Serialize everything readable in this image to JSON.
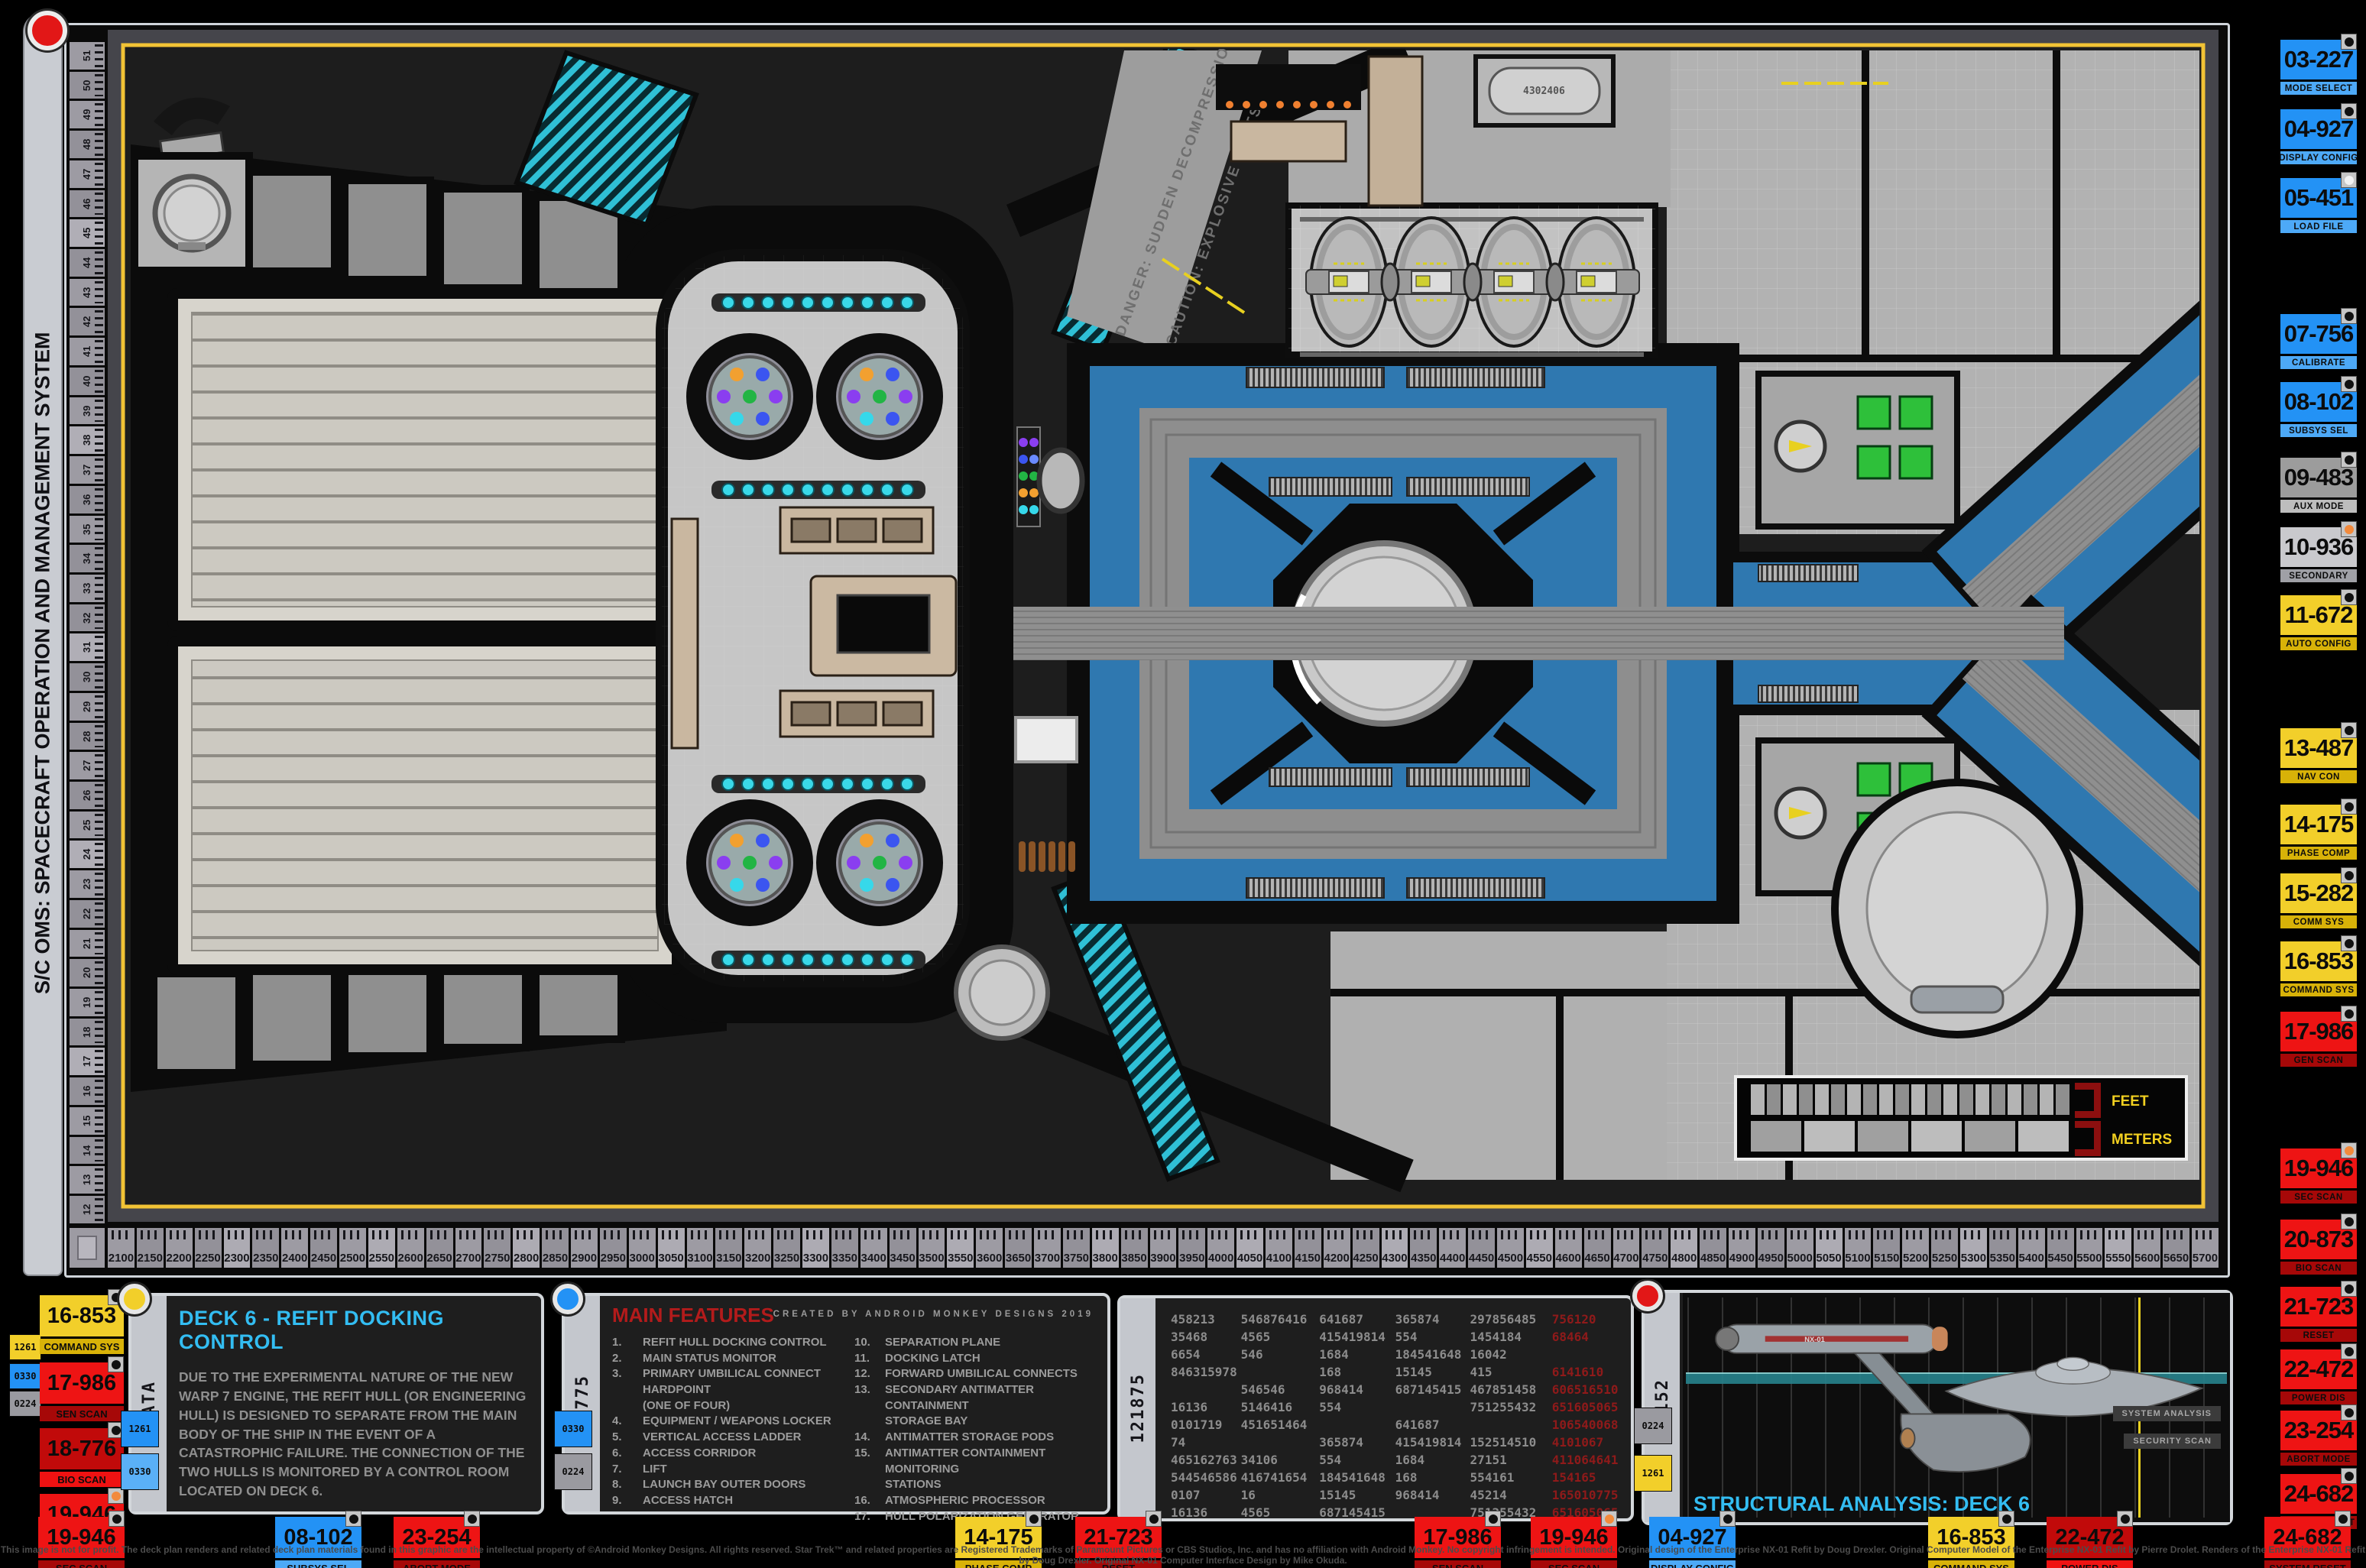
{
  "palette": {
    "blue": "#2392f5",
    "blue_label": "#4da9f7",
    "yellow": "#f2cf2a",
    "yellow_label": "#d8b208",
    "red": "#ee1414",
    "red_label": "#a60808",
    "dark_red": "#c10a0a",
    "dark_red_label": "#ef1212",
    "gray": "#9c9c9c",
    "gray_label": "#bdbdbd",
    "lightgray": "#c9c9cd",
    "lightgray_label": "#9fa0a6",
    "chip_yellow": "#f2cf2a",
    "chip_blue": "#2392f5",
    "chip_lightblue": "#5ab0f7",
    "chip_gray": "#9a9aa0",
    "dot_black": "#111111",
    "dot_orange": "#f28a3c",
    "dot_white": "#f2f2f2",
    "accent_cyan": "#33bdf2",
    "feature_red": "#b31b1b",
    "plan_blue": "#2f78b0",
    "teal": "#36c3d9",
    "ruler_yellow": "#f2c335"
  },
  "left_bar": {
    "title": "S/C OMS: SPACECRAFT OPERATION AND MANAGEMENT SYSTEM"
  },
  "rulers": {
    "horizontal": {
      "first": 2100,
      "last": 5700,
      "step": 50
    },
    "vertical": {
      "first": 51,
      "last": 12,
      "step": -1
    }
  },
  "plan": {
    "danger1": "DANGER: SUDDEN DECOMPRESSION AREA",
    "danger2": "CAUTION: EXPLOSIVE BOLTS",
    "feet": "FEET",
    "meters": "METERS",
    "cylinder_label": "4302406"
  },
  "right_sidebar": {
    "buttons": [
      {
        "code": "03-227",
        "label": "MODE SELECT",
        "color": "blue",
        "dot": "black"
      },
      {
        "code": "04-927",
        "label": "DISPLAY CONFIG",
        "color": "blue",
        "dot": "black"
      },
      {
        "code": "05-451",
        "label": "LOAD FILE",
        "color": "blue",
        "dot": "white"
      },
      {
        "code": "07-756",
        "label": "CALIBRATE",
        "color": "blue",
        "dot": "black"
      },
      {
        "code": "08-102",
        "label": "SUBSYS SEL",
        "color": "blue",
        "dot": "black"
      },
      {
        "code": "09-483",
        "label": "AUX MODE",
        "color": "gray",
        "dot": "black"
      },
      {
        "code": "10-936",
        "label": "SECONDARY",
        "color": "lightgray",
        "dot": "orange"
      },
      {
        "code": "11-672",
        "label": "AUTO CONFIG",
        "color": "yellow",
        "dot": "black"
      },
      {
        "code": "13-487",
        "label": "NAV CON",
        "color": "yellow",
        "dot": "black"
      },
      {
        "code": "14-175",
        "label": "PHASE COMP",
        "color": "yellow",
        "dot": "black"
      },
      {
        "code": "15-282",
        "label": "COMM SYS",
        "color": "yellow",
        "dot": "black"
      },
      {
        "code": "16-853",
        "label": "COMMAND SYS",
        "color": "yellow",
        "dot": "black"
      },
      {
        "code": "17-986",
        "label": "GEN SCAN",
        "color": "red",
        "dot": "black"
      },
      {
        "code": "19-946",
        "label": "SEC SCAN",
        "color": "red",
        "dot": "orange"
      },
      {
        "code": "20-873",
        "label": "BIO SCAN",
        "color": "red",
        "dot": "black"
      },
      {
        "code": "21-723",
        "label": "RESET",
        "color": "red",
        "dot": "black"
      },
      {
        "code": "22-472",
        "label": "POWER DIS",
        "color": "red",
        "dot": "black"
      },
      {
        "code": "23-254",
        "label": "ABORT MODE",
        "color": "red",
        "dot": "black"
      },
      {
        "code": "24-682",
        "label": "SYSTEM RESET",
        "color": "red",
        "dot": "black"
      }
    ]
  },
  "bottom": {
    "left_chips": [
      {
        "text": "1261",
        "color": "chip_yellow"
      },
      {
        "text": "0330",
        "color": "chip_blue"
      },
      {
        "text": "0224",
        "color": "chip_gray"
      }
    ],
    "left_buttons": [
      {
        "code": "16-853",
        "label": "COMMAND SYS",
        "color": "yellow",
        "dot": "black"
      },
      {
        "code": "17-986",
        "label": "SEN SCAN",
        "color": "red",
        "dot": "black"
      },
      {
        "code": "18-776",
        "label": "BIO SCAN",
        "color": "dark_red",
        "dot": "black"
      },
      {
        "code": "19-946",
        "label": "SEC SCAN",
        "color": "red",
        "dot": "orange"
      }
    ],
    "data_panel": {
      "tab": "DATA",
      "chips": [
        {
          "text": "1261",
          "color": "chip_blue"
        },
        {
          "text": "0330",
          "color": "chip_lightblue"
        }
      ],
      "title": "DECK 6 - REFIT DOCKING CONTROL",
      "body": "DUE TO THE EXPERIMENTAL NATURE OF THE NEW WARP 7 ENGINE, THE REFIT HULL (OR ENGINEERING HULL) IS DESIGNED TO SEPARATE FROM THE MAIN BODY OF THE SHIP IN THE EVENT OF A CATASTROPHIC FAILURE. THE CONNECTION OF THE TWO HULLS IS MONITORED BY A CONTROL ROOM LOCATED ON DECK 6."
    },
    "features_panel": {
      "tab": "10775",
      "chips": [
        {
          "text": "0330",
          "color": "chip_blue"
        },
        {
          "text": "0224",
          "color": "chip_gray"
        }
      ],
      "title": "MAIN FEATURES",
      "credit": "CREATED BY ANDROID MONKEY DESIGNS 2019",
      "left": [
        {
          "n": "1.",
          "t": "REFIT HULL DOCKING CONTROL"
        },
        {
          "n": "2.",
          "t": "MAIN STATUS MONITOR"
        },
        {
          "n": "3.",
          "t": "PRIMARY UMBILICAL CONNECT HARDPOINT"
        },
        {
          "n": "",
          "t": "(ONE OF FOUR)"
        },
        {
          "n": "4.",
          "t": "EQUIPMENT / WEAPONS LOCKER"
        },
        {
          "n": "5.",
          "t": "VERTICAL ACCESS LADDER"
        },
        {
          "n": "6.",
          "t": "ACCESS CORRIDOR"
        },
        {
          "n": "7.",
          "t": "LIFT"
        },
        {
          "n": "8.",
          "t": "LAUNCH BAY OUTER DOORS"
        },
        {
          "n": "9.",
          "t": "ACCESS HATCH"
        }
      ],
      "right": [
        {
          "n": "10.",
          "t": "SEPARATION PLANE"
        },
        {
          "n": "11.",
          "t": "DOCKING LATCH"
        },
        {
          "n": "12.",
          "t": "FORWARD UMBILICAL CONNECTS"
        },
        {
          "n": "13.",
          "t": "SECONDARY ANTIMATTER CONTAINMENT"
        },
        {
          "n": "",
          "t": "STORAGE BAY"
        },
        {
          "n": "14.",
          "t": "ANTIMATTER STORAGE PODS"
        },
        {
          "n": "15.",
          "t": "ANTIMATTER CONTAINMENT MONITORING"
        },
        {
          "n": "",
          "t": "STATIONS"
        },
        {
          "n": "16.",
          "t": "ATMOSPHERIC PROCESSOR"
        },
        {
          "n": "17.",
          "t": "HULL POLARIZATION GENERATOR"
        }
      ]
    },
    "numbers_panel": {
      "tab": "121875",
      "columns": [
        [
          "458213",
          "35468",
          "6654",
          "846315978",
          "",
          "16136",
          "0101719",
          "74",
          "465162763",
          "544546586",
          "0107",
          "16136"
        ],
        [
          "546876416",
          "4565",
          "546",
          "",
          "546546",
          "5146416",
          "451651464",
          "",
          "34106",
          "416741654",
          "16",
          "4565"
        ],
        [
          "641687",
          "415419814",
          "1684",
          "168",
          "968414",
          "554",
          "",
          "365874",
          "554",
          "184541648",
          "15145",
          "687145415"
        ],
        [
          "365874",
          "554",
          "184541648",
          "15145",
          "687145415",
          "",
          "641687",
          "415419814",
          "1684",
          "168",
          "968414",
          ""
        ],
        [
          "297856485",
          "1454184",
          "16042",
          "415",
          "467851458",
          "751255432",
          "",
          "152514510",
          "27151",
          "554161",
          "45214",
          "751255432"
        ]
      ],
      "red_column": [
        "756120",
        "68464",
        "",
        "6141610",
        "606516510",
        "651605065",
        "106540068",
        "4101067",
        "411064641",
        "154165",
        "165010775",
        "651605065"
      ]
    },
    "structural_panel": {
      "tab": "81152",
      "chips": [
        {
          "text": "0224",
          "color": "chip_gray"
        },
        {
          "text": "1261",
          "color": "chip_yellow"
        }
      ],
      "title": "STRUCTURAL ANALYSIS: DECK 6",
      "tags": [
        "SYSTEM ANALYSIS",
        "SECURITY SCAN"
      ],
      "ship_registry": "NX-01"
    },
    "row_buttons": [
      {
        "code": "19-946",
        "label": "SEC SCAN",
        "color": "red",
        "dot": "black"
      },
      {
        "code": "08-102",
        "label": "SUBSYS SEL",
        "color": "blue",
        "dot": "black"
      },
      {
        "code": "23-254",
        "label": "ABORT MODE",
        "color": "red",
        "dot": "black"
      },
      {
        "code": "14-175",
        "label": "PHASE COMP",
        "color": "yellow",
        "dot": "black"
      },
      {
        "code": "21-723",
        "label": "RESET",
        "color": "red",
        "dot": "black"
      },
      {
        "code": "17-986",
        "label": "SEN SCAN",
        "color": "red",
        "dot": "black"
      },
      {
        "code": "19-946",
        "label": "SEC SCAN",
        "color": "red",
        "dot": "orange"
      },
      {
        "code": "04-927",
        "label": "DISPLAY CONFIG",
        "color": "blue",
        "dot": "black"
      },
      {
        "code": "16-853",
        "label": "COMMAND SYS",
        "color": "yellow",
        "dot": "black"
      },
      {
        "code": "22-472",
        "label": "POWER DIS",
        "color": "dark_red",
        "dot": "black"
      },
      {
        "code": "24-682",
        "label": "SYSTEM RESET",
        "color": "red",
        "dot": "black"
      }
    ]
  },
  "footer": "This image is not for profit. The deck plan renders and related deck plan materials found in this graphic are the intellectual property of ©Android Monkey Designs. All rights reserved. Star Trek™ and related properties are Registered Trademarks of Paramount Pictures or CBS Studios, Inc. and has no affiliation with Android Monkey. No copyright infringement is intended. Original design of the Enterprise NX-01 Refit by Doug Drexler. Original Computer Model of the Enterprise NX-01 Refit by Pierre Drolet. Renders of the Enterprise NX-01 Refit by Doug Drexler. Original NX-01 Computer Interface Design by Mike Okuda."
}
